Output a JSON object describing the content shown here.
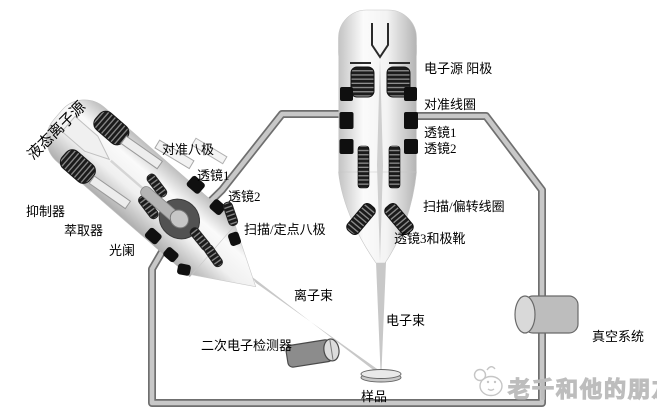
{
  "colors": {
    "background": "#ffffff",
    "wall_fill": "#c8c8c8",
    "wall_edge": "#6f6f6f",
    "column_light": "#fafafa",
    "column_dark": "#b5b5b5",
    "electrode_black": "#111111",
    "beam_gray": "#c8c8c8",
    "text": "#000000",
    "watermark_gray": "#bdbdbd"
  },
  "icons": {
    "watermark_logo": "sketch-mascot-icon"
  },
  "labels": {
    "ion_source": "液态离子源",
    "suppressor": "抑制器",
    "extractor": "萃取器",
    "aperture": "光阑",
    "alignment_octopole": "对准八极",
    "ion_lens1": "透镜1",
    "ion_lens2": "透镜2",
    "scan_spot_octopole": "扫描/定点八极",
    "ion_beam": "离子束",
    "se_detector": "二次电子检测器",
    "sample": "样品",
    "electron_beam": "电子束",
    "electron_source_anode": "电子源 阳极",
    "alignment_coil": "对准线圈",
    "e_lens1": "透镜1",
    "e_lens2": "透镜2",
    "scan_deflection_coil": "扫描/偏转线圈",
    "lens3_pole_piece": "透镜3和极靴",
    "vacuum_system": "真空系统",
    "watermark": "老千和他的朋友们"
  }
}
